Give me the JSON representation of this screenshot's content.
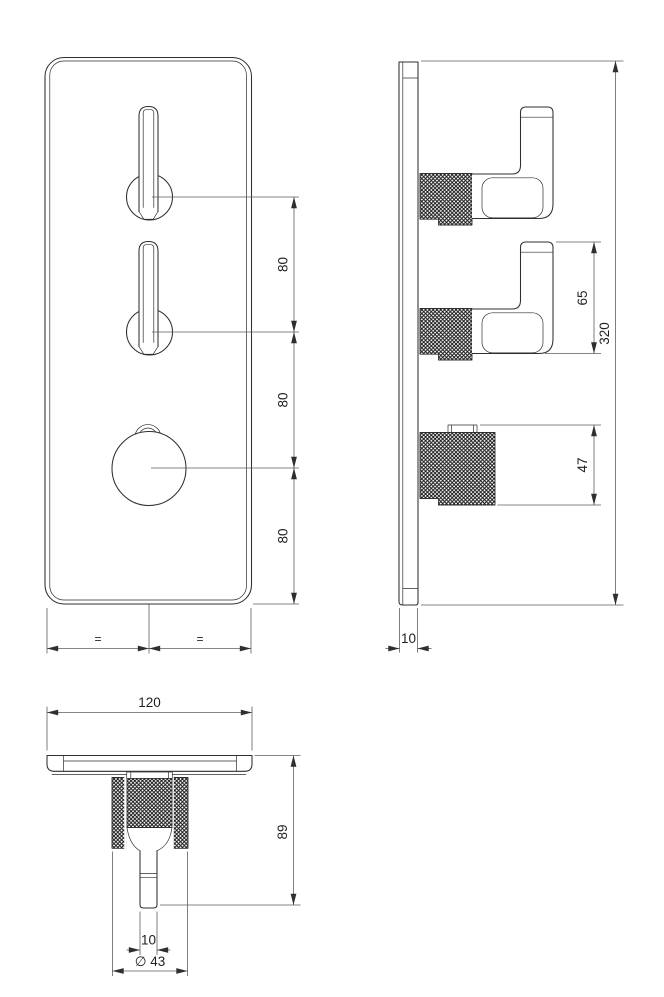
{
  "drawing": {
    "colors": {
      "background": "#ffffff",
      "part_line": "#2f2f2f",
      "dimension_line": "#5e5e5e",
      "text": "#1f1f1f"
    },
    "front_view": {
      "spacing_top": "80",
      "spacing_mid": "80",
      "spacing_bottom": "80",
      "equal_left": "=",
      "equal_right": "="
    },
    "side_view": {
      "handle_height": "65",
      "plate_height": "320",
      "knob_height": "47",
      "plate_thickness": "10"
    },
    "bottom_view": {
      "plate_width": "120",
      "total_depth": "89",
      "lever_thickness": "10",
      "knob_diameter": "∅ 43"
    }
  }
}
